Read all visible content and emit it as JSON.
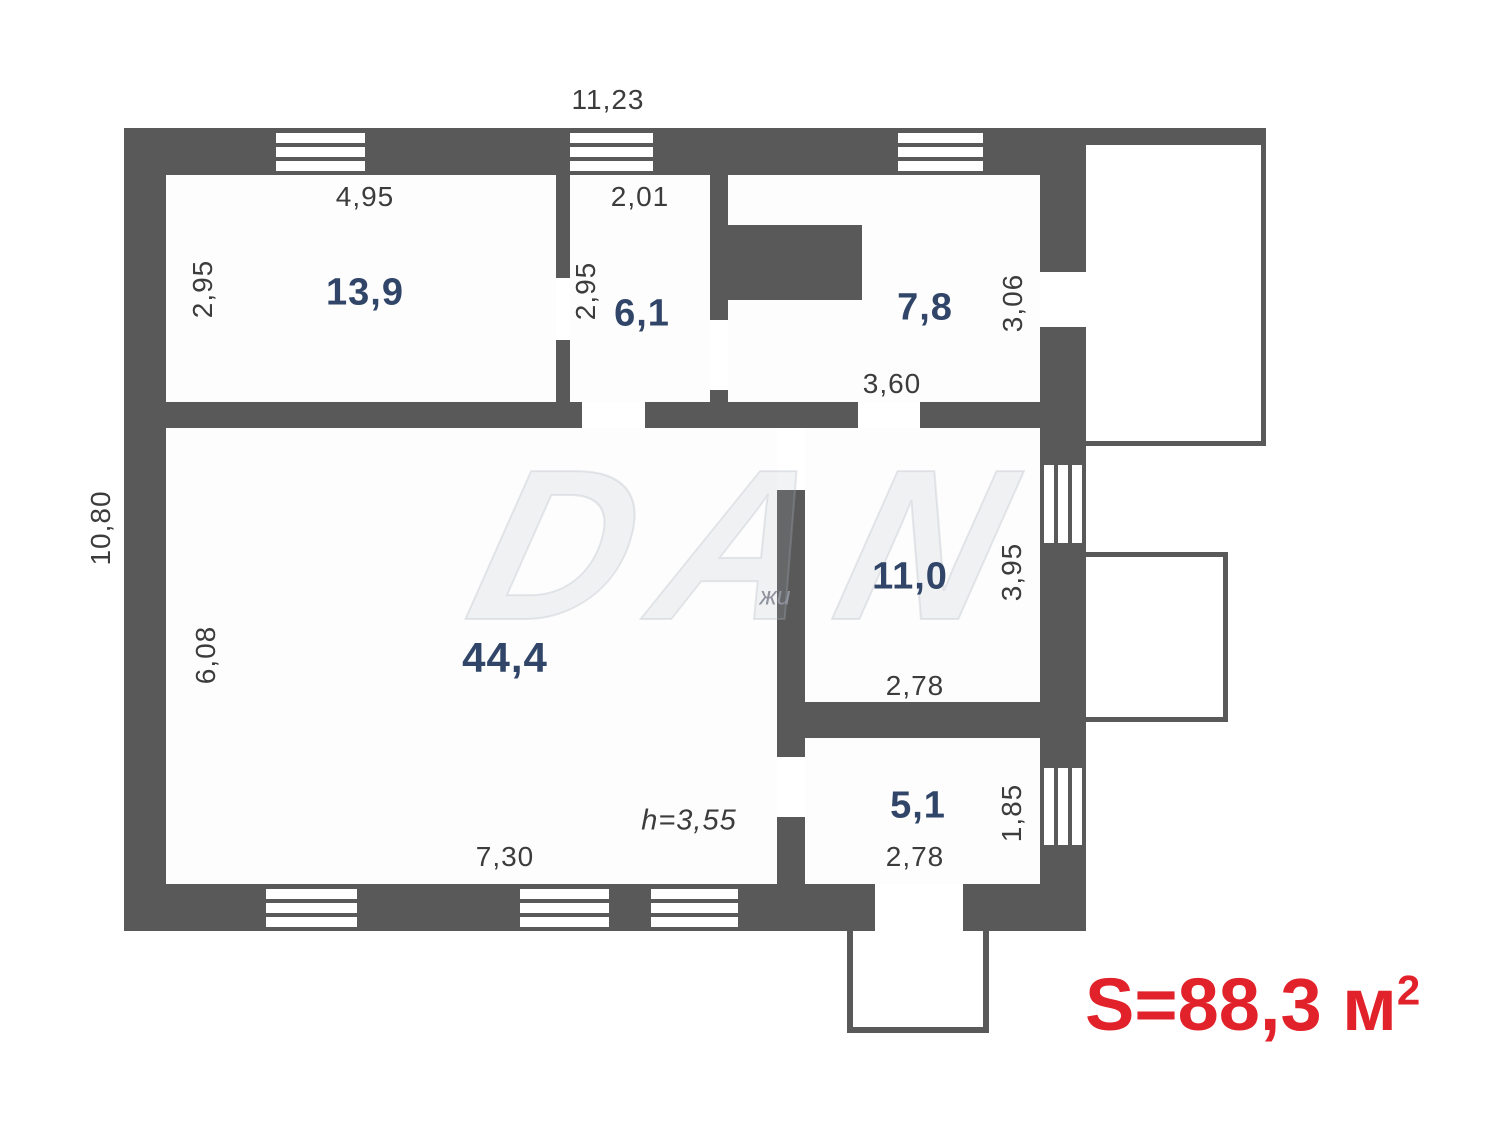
{
  "plan": {
    "type": "floor-plan",
    "total_area": {
      "text": "S=88,3 м",
      "sup": "2"
    },
    "outer_dimensions": {
      "width": "11,23",
      "height": "10,80"
    },
    "ceiling_height": "h=3,55",
    "rooms": [
      {
        "id": "room-13-9",
        "area": "13,9",
        "width": "4,95",
        "height": "2,95"
      },
      {
        "id": "room-6-1",
        "area": "6,1",
        "width": "2,01",
        "height": "2,95"
      },
      {
        "id": "room-7-8",
        "area": "7,8",
        "width": "3,60",
        "height": "3,06"
      },
      {
        "id": "room-44-4",
        "area": "44,4",
        "width": "7,30",
        "height": "6,08"
      },
      {
        "id": "room-11-0",
        "area": "11,0",
        "width": "2,78",
        "height": "3,95"
      },
      {
        "id": "room-5-1",
        "area": "5,1",
        "width": "2,78",
        "height": "1,85"
      }
    ],
    "watermark": {
      "big": "DAN",
      "small": "жи"
    },
    "colors": {
      "wall": "#595959",
      "room_area_text": "#304567",
      "dimension_text": "#3c3c3c",
      "total_area_text": "#e2222a"
    }
  }
}
